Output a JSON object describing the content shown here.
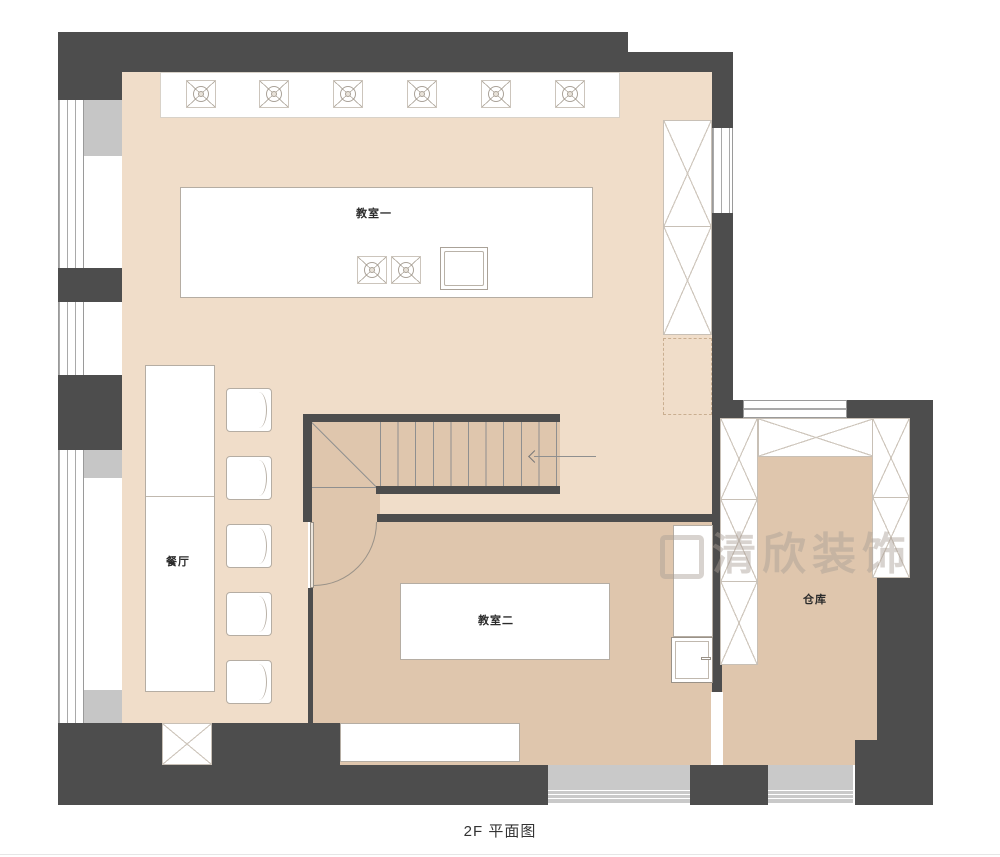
{
  "plan": {
    "caption": "2F 平面图",
    "watermark": "清欣装饰",
    "rooms": {
      "classroom1": "教室一",
      "dining": "餐厅",
      "classroom2": "教室二",
      "storage": "仓库"
    },
    "counts": {
      "ceiling_fans": 6,
      "classroom1_table_fans": 2,
      "dining_chairs": 5,
      "stair_treads": 10,
      "storage_cabinet_cells": 6
    },
    "colors": {
      "wall": "#4d4d4d",
      "floor_light": "#f0ddc9",
      "floor_tan": "#dfc6ad",
      "window_sill": "#c6c6c6",
      "furniture_line": "#b5ada3"
    }
  }
}
